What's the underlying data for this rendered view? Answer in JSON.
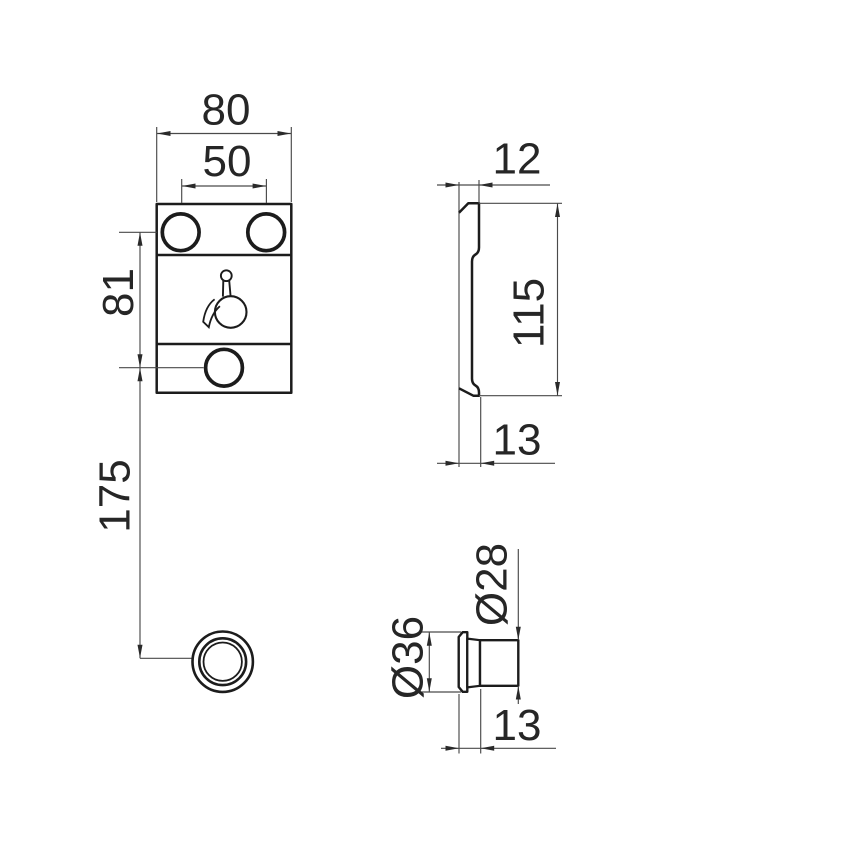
{
  "drawing": {
    "plate_front_view": {
      "width": "80",
      "hole_spacing": "50",
      "holes_to_knob_hole": "81",
      "knob_hole_to_control": "175",
      "pictogram_icon": "disabled-access-icon"
    },
    "plate_side_view": {
      "thickness_top": "12",
      "height": "115",
      "thickness_bottom": "13"
    },
    "knob_detail_view": {
      "flange_diameter": "Ø36",
      "knob_diameter": "Ø28",
      "protrusion": "13"
    }
  },
  "colors": {
    "background": "#ffffff",
    "outline": "#1c1c1c",
    "dimension_line": "#4a4a4a",
    "dimension_text": "#262626"
  }
}
